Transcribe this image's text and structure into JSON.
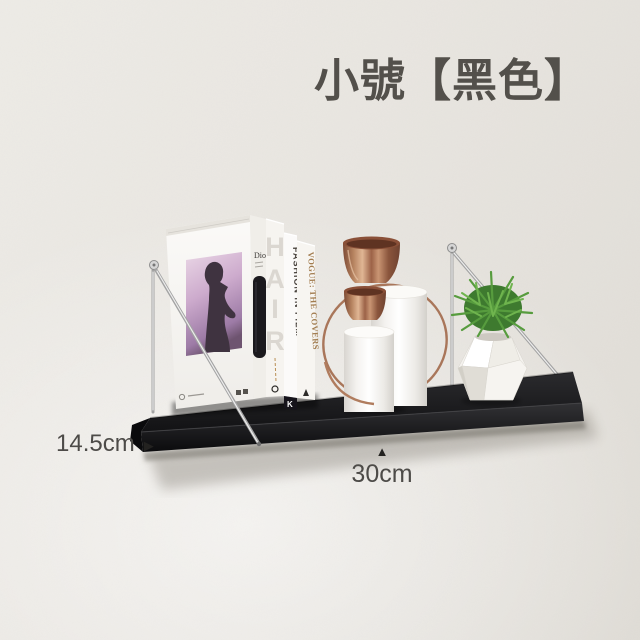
{
  "title": {
    "text": "小號【黑色】",
    "color": "#53504b"
  },
  "dimension_labels": {
    "depth": {
      "value": "14.5cm",
      "arrow": "▶"
    },
    "width": {
      "value": "30cm",
      "arrow": "▲"
    }
  },
  "books": {
    "front_cover_brand": "Dior",
    "spines": [
      {
        "title": "HAIR",
        "letters": [
          "H",
          "A",
          "I",
          "R"
        ],
        "text_color": "#dbd7d1"
      },
      {
        "title": "FASHION IN FILM",
        "text_color": "#46403a"
      },
      {
        "title": "VOGUE: THE COVERS",
        "text_color": "#a27c4f"
      }
    ],
    "publisher_logo": "K"
  },
  "product": {
    "shelf_color": "#1c1c1e",
    "bracket_color": "#a3a3a3",
    "copper_color": "#a9765a",
    "ceramic_color": "#f7f5f2",
    "plant_color": "#579c3e",
    "wall_color": "#e9e6e1"
  }
}
